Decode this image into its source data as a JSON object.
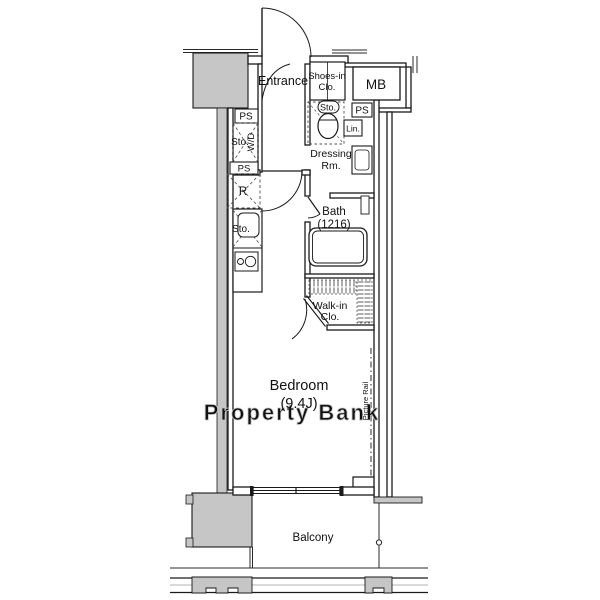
{
  "plan": {
    "kind": "apartment-floorplan",
    "labels": {
      "entrance": "Entrance",
      "shoes_in_closet": [
        "Shoes-in",
        "Clo."
      ],
      "meter_box": "MB",
      "pipe_space_top_left": "PS",
      "pipe_space_mid_left": "PS",
      "pipe_space_right": "PS",
      "storage_laundry": "Sto.",
      "washer_dryer": "W/D",
      "storage_toilet": "Sto.",
      "linen": "Lin.",
      "dressing_room": [
        "Dressing",
        "Rm."
      ],
      "refrigerator": "R",
      "storage_kitchen": "Sto.",
      "bath": [
        "Bath",
        "(1216)"
      ],
      "walk_in_closet": [
        "Walk-in",
        "Clo."
      ],
      "bedroom": [
        "Bedroom",
        "(9.4J)"
      ],
      "picture_rail": "Picture Rail",
      "balcony": "Balcony",
      "watermark": "Property Bank"
    },
    "colors": {
      "wall": "#1a1a1a",
      "pillar_fill": "#c6c6c6",
      "watermark_fill": "#e7e7e7",
      "watermark_edge": "#c2c2c2",
      "background": "#ffffff"
    }
  }
}
